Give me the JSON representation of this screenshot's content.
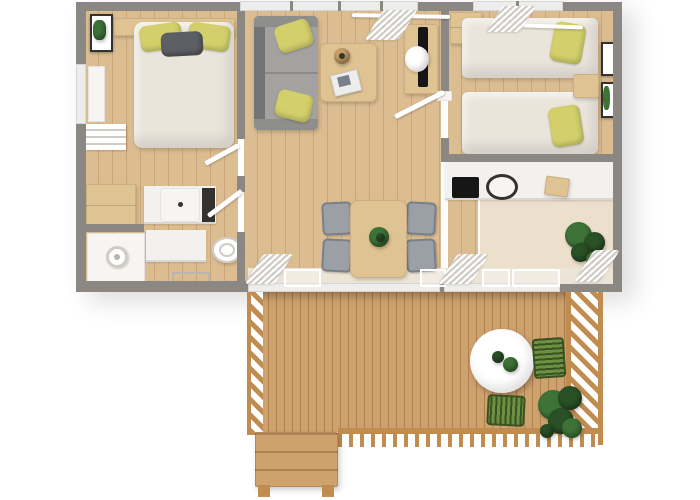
{
  "meta": {
    "kind": "3d-top-view-floor-plan-render",
    "canvas": {
      "width": 700,
      "height": 500
    }
  },
  "scene": {
    "areas": [
      {
        "id": "bedroom-main",
        "contents": [
          "double-bed",
          "yellow-pillows",
          "gray-pillow",
          "headboard",
          "wall-art-plant",
          "window",
          "towel-shelf",
          "wardrobe"
        ]
      },
      {
        "id": "bathroom",
        "contents": [
          "shower",
          "shower-head",
          "vanity-sink",
          "toilet",
          "floor-drain",
          "cabinet"
        ]
      },
      {
        "id": "living-room",
        "contents": [
          "sofa",
          "sofa-pillows",
          "coffee-table",
          "magazine",
          "bowl",
          "tv-desk",
          "tv",
          "desk-chair",
          "dining-table",
          "table-plant",
          "dining-chairs-x4",
          "window-curtains",
          "sliding-door-curtains"
        ]
      },
      {
        "id": "kitchen",
        "contents": [
          "counter",
          "cooktop",
          "round-sink",
          "cutting-board",
          "potted-plant",
          "sliding-door"
        ]
      },
      {
        "id": "bedroom-twin",
        "contents": [
          "single-bed-x2",
          "yellow-pillow-x2",
          "nightstand",
          "wardrobe",
          "wall-art-x2",
          "window-curtains"
        ]
      },
      {
        "id": "terrace",
        "contents": [
          "deck-planks",
          "railing-left",
          "railing-right",
          "railing-bottom",
          "round-table",
          "table-plants",
          "green-chair-x2",
          "potted-plant",
          "wooden-steps"
        ]
      }
    ]
  },
  "palette": {
    "bg": "#ffffff",
    "wall": "#8b8884",
    "beige": "#ece4d6",
    "floor": "#dcbd92",
    "floor_line": "#cba67a",
    "floor_pale": "#ecdfcb",
    "deck": "#cea26d",
    "deck_line": "#b08050",
    "rail": "#c08c50",
    "white": "#ffffff",
    "off_white": "#f7f5f2",
    "glass": "#edeeec",
    "curtain_shade": "#cfccc6",
    "duvet": "#eae4db",
    "pillow": "#d3d06c",
    "gray_pillow": "#5c5f64",
    "sofa": "#a3a2a0",
    "sofa_dark": "#737476",
    "sofa_arm": "#8e8e8c",
    "wood": "#e0c392",
    "wood_dark": "#c59e68",
    "chair": "#9aa0a6",
    "chair_dark": "#798089",
    "green": "#3e7338",
    "green_dark": "#2a5026",
    "chair_green": "#6d9143",
    "chair_green_dark": "#3a5122",
    "counter": "#f3f1ed",
    "cooktop": "#161616",
    "frame": "#33322f",
    "drain": "#b9b6b1"
  }
}
